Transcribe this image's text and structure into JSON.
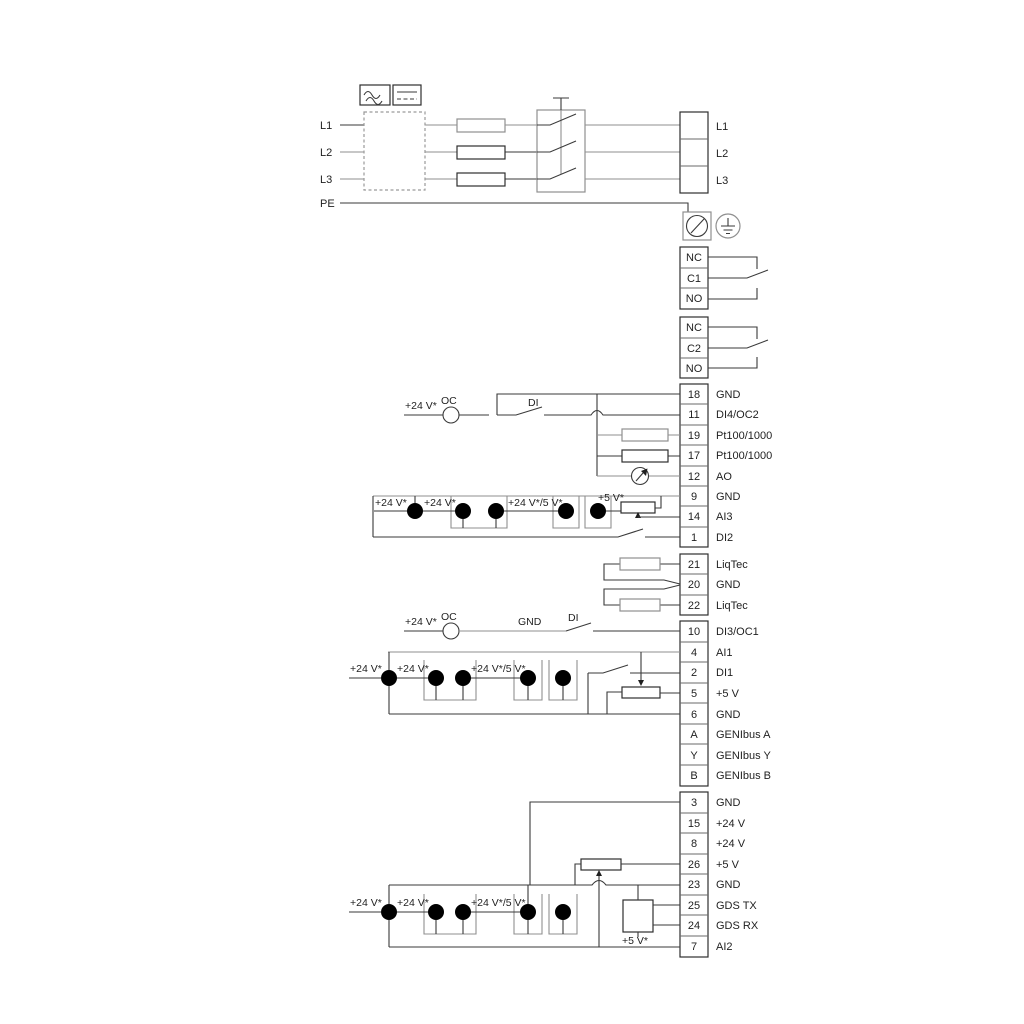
{
  "colors": {
    "background": "#ffffff",
    "wire_dark": "#3a3a3a",
    "wire_gray": "#8f8f8f",
    "text": "#1f1f1f"
  },
  "power": {
    "inputs": [
      "L1",
      "L2",
      "L3",
      "PE"
    ],
    "outputs": [
      "L1",
      "L2",
      "L3"
    ]
  },
  "relays": [
    {
      "terminals": [
        "NC",
        "C1",
        "NO"
      ]
    },
    {
      "terminals": [
        "NC",
        "C2",
        "NO"
      ]
    }
  ],
  "terminals": {
    "analog_io": [
      {
        "num": "18",
        "label": "GND"
      },
      {
        "num": "11",
        "label": "DI4/OC2"
      },
      {
        "num": "19",
        "label": "Pt100/1000"
      },
      {
        "num": "17",
        "label": "Pt100/1000"
      },
      {
        "num": "12",
        "label": "AO"
      },
      {
        "num": "9",
        "label": "GND"
      },
      {
        "num": "14",
        "label": "AI3"
      },
      {
        "num": "1",
        "label": "DI2"
      }
    ],
    "liqtec": [
      {
        "num": "21",
        "label": "LiqTec"
      },
      {
        "num": "20",
        "label": "GND"
      },
      {
        "num": "22",
        "label": "LiqTec"
      }
    ],
    "digital_io": [
      {
        "num": "10",
        "label": "DI3/OC1"
      },
      {
        "num": "4",
        "label": "AI1"
      },
      {
        "num": "2",
        "label": "DI1"
      },
      {
        "num": "5",
        "label": "+5 V"
      },
      {
        "num": "6",
        "label": "GND"
      },
      {
        "num": "A",
        "label": "GENIbus A"
      },
      {
        "num": "Y",
        "label": "GENIbus Y"
      },
      {
        "num": "B",
        "label": "GENIbus B"
      }
    ],
    "power_io": [
      {
        "num": "3",
        "label": "GND"
      },
      {
        "num": "15",
        "label": "+24 V"
      },
      {
        "num": "8",
        "label": "+24 V"
      },
      {
        "num": "26",
        "label": "+5 V"
      },
      {
        "num": "23",
        "label": "GND"
      },
      {
        "num": "25",
        "label": "GDS TX"
      },
      {
        "num": "24",
        "label": "GDS RX"
      },
      {
        "num": "7",
        "label": "AI2"
      }
    ]
  },
  "annotations": {
    "v24": "+24 V*",
    "v24v5": "+24 V*/5 V*",
    "v5": "+5 V*",
    "oc": "OC",
    "di": "DI",
    "gnd": "GND"
  }
}
